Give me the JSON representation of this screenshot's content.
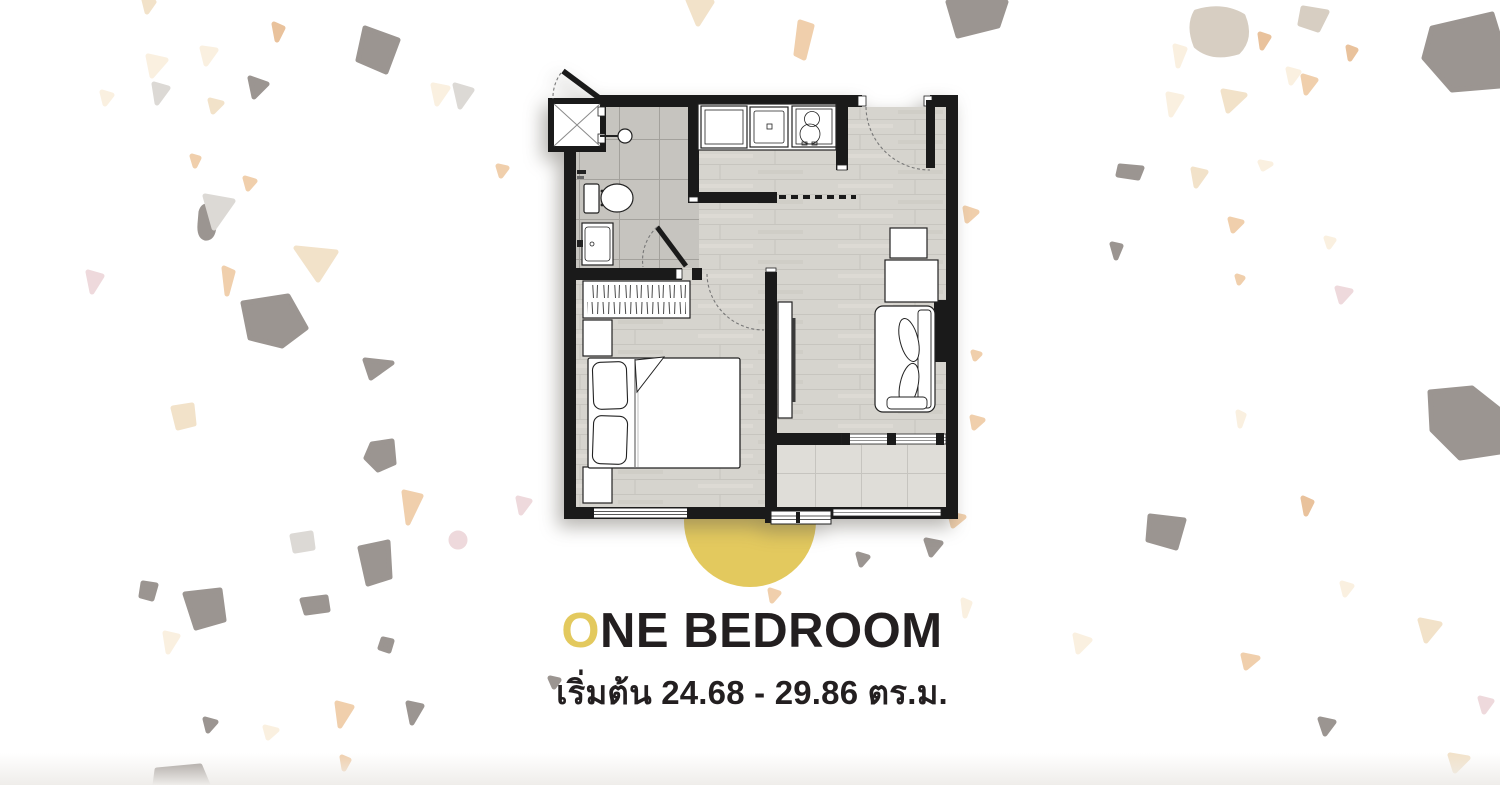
{
  "caption": {
    "title_highlight": "O",
    "title_rest": "NE BEDROOM",
    "title_full": "ONE BEDROOM",
    "subtitle": "เริ่มต้น 24.68 - 29.86 ตร.ม."
  },
  "area_range": {
    "prefix_th": "เริ่มต้น",
    "min_sqm": "24.68",
    "max_sqm": "29.86",
    "unit_th": "ตร.ม."
  },
  "colors": {
    "page-bg": "#ffffff",
    "ink": "#231f20",
    "accent": "#e3c95e",
    "wall": "#1a1a1a",
    "wood-floor": "#d6d4ce",
    "wood-line": "#c7c5bf",
    "bath-tile": "#c6c4bf",
    "bath-line": "#a3a19c",
    "balcony-tile": "#dfddd8",
    "balcony-line": "#c6c4bf",
    "terrazzo-gray": "#9b9591",
    "terrazzo-lightgray": "#dcd9d5",
    "terrazzo-cream": "#faf0e0",
    "terrazzo-beige": "#f2e2c9",
    "terrazzo-peach": "#f0cfac",
    "terrazzo-tan": "#e9c29c",
    "terrazzo-pink": "#eed9dc",
    "terrazzo-graybeige": "#d7cec2"
  },
  "floor_plan": {
    "label": "one-bedroom-unit-floor-plan",
    "rooms": [
      "bathroom",
      "kitchen",
      "living-area",
      "bedroom",
      "balcony"
    ],
    "fixture_icons": [
      "shower-cabin-icon",
      "shower-head-icon",
      "toilet-icon",
      "basin-icon",
      "fridge-icon",
      "kitchen-sink-icon",
      "stove-icon",
      "wardrobe-icon",
      "nightstand-icon",
      "double-bed-icon",
      "tv-cabinet-icon",
      "side-table-icon",
      "sofa-icon",
      "entrance-door-icon",
      "window-icon",
      "sliding-door-icon",
      "ac-unit-icon"
    ]
  }
}
